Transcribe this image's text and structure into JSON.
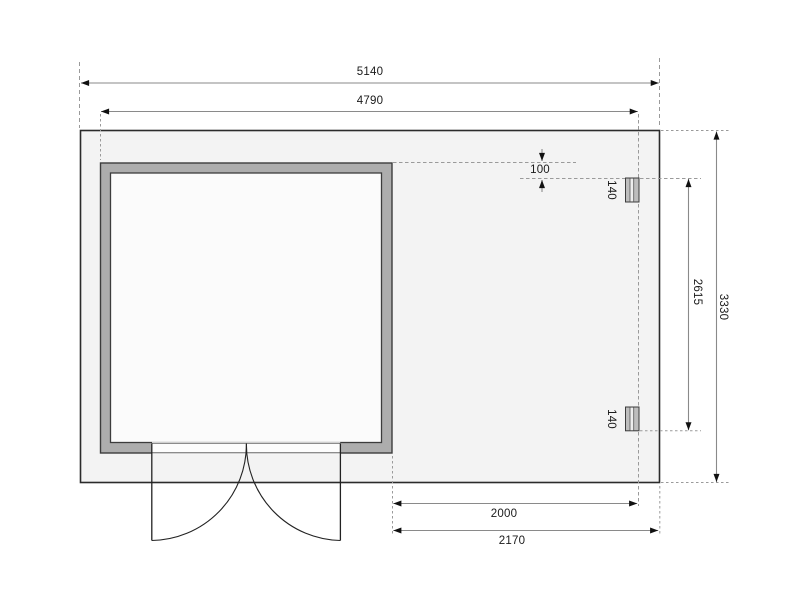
{
  "drawing": {
    "type": "garden-house floor plan",
    "dims": {
      "total_width": "5140",
      "house_width": "4790",
      "total_depth": "3330",
      "post_span": "2615",
      "wall_post_offset": "100",
      "post_width_top": "140",
      "post_width_bottom": "140",
      "post_bay_width": "2000",
      "annex_width": "2170"
    },
    "colors": {
      "plan_fill": "#f3f3f3",
      "wall_fill": "#adadad",
      "interior_fill": "#fbfbfb",
      "outline": "#2b2b2b",
      "dim_line": "#8a8a8a",
      "guide_line": "#9a9a9a",
      "text": "#1a1a1a"
    }
  }
}
